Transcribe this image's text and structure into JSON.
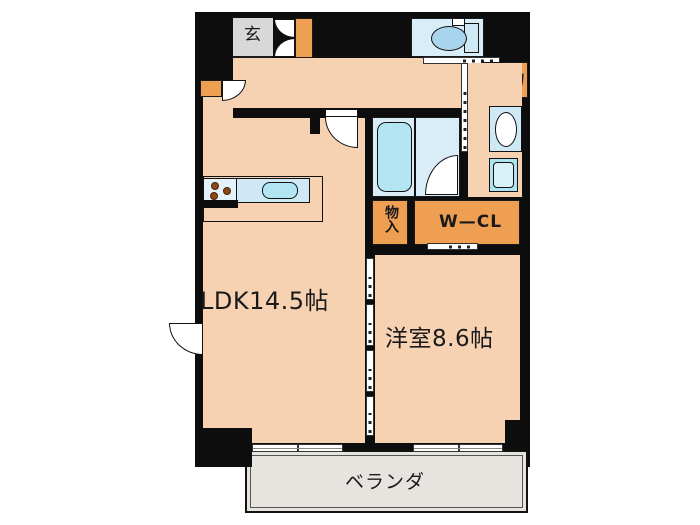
{
  "floorplan": {
    "title": "1LDK apartment floor plan",
    "rooms": {
      "genkan": {
        "label": "玄"
      },
      "ldk": {
        "label": "LDK14.5帖"
      },
      "western_room": {
        "label": "洋室8.6帖"
      },
      "walk_in_closet": {
        "label": "W—CL"
      },
      "storage": {
        "label": "物"
      },
      "storage_closet": {
        "label": "物入"
      },
      "veranda": {
        "label": "ベランダ"
      }
    },
    "fixtures": [
      "toilet",
      "bathtub",
      "washbasin",
      "washing-machine-pan",
      "kitchen-sink",
      "stove"
    ],
    "colors": {
      "wall": "#0d0d0d",
      "floor": "#f6d2b3",
      "closet_orange": "#ef9f52",
      "wet_area_blue": "#d8edf8",
      "fixture_cyan": "#b2e5f2",
      "genkan_gray": "#d8d8d8",
      "veranda_gray": "#e7e4e0"
    }
  }
}
